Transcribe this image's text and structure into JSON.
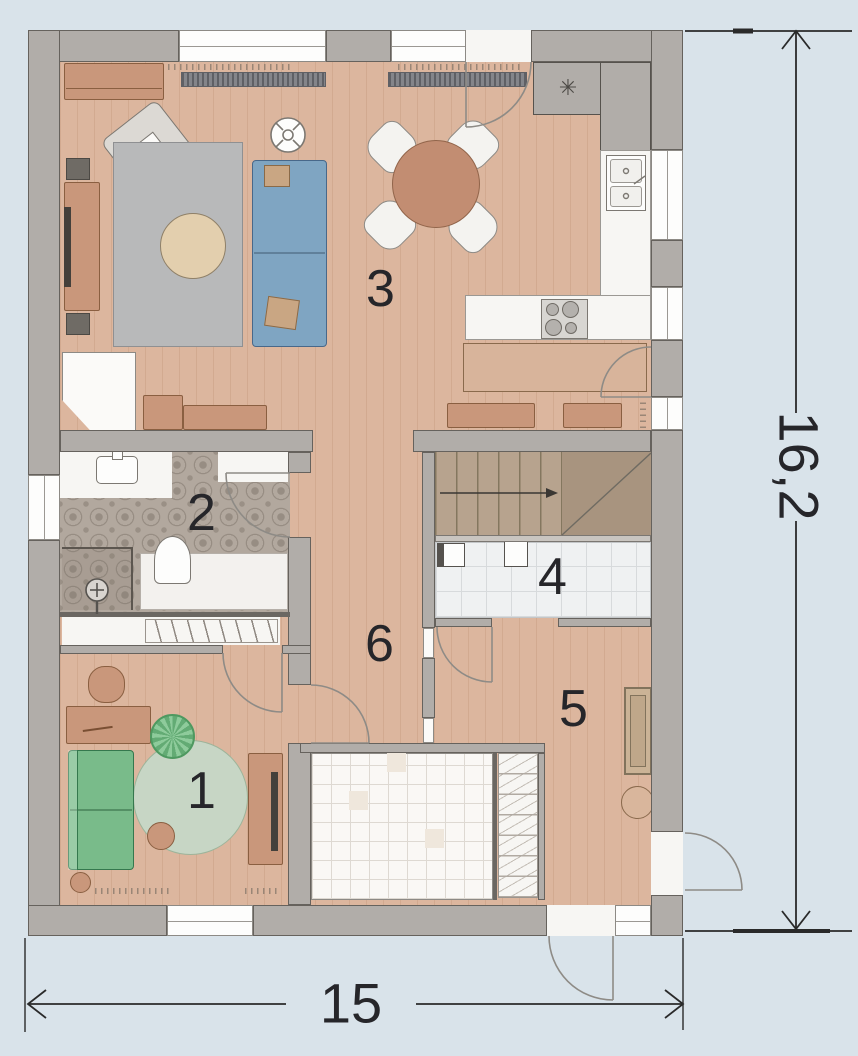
{
  "plan": {
    "rooms": {
      "r1": {
        "label": "1"
      },
      "r2": {
        "label": "2"
      },
      "r3": {
        "label": "3"
      },
      "r4": {
        "label": "4"
      },
      "r5": {
        "label": "5"
      },
      "r6": {
        "label": "6"
      }
    },
    "dimensions": {
      "width_label": "15",
      "height_label": "16,2"
    },
    "icons": {
      "freezer_icon": "✳"
    },
    "colors": {
      "background": "#d9e3ea",
      "wall": "#b1ada9",
      "wall_outline": "#66625d",
      "wood_floor": "#dcb69e",
      "bathroom_tile": "#b2a89e",
      "sofa_blue": "#7fa5c2",
      "sofa_green": "#79bb8a",
      "furniture_tan": "#c9977b",
      "dimension_line": "#2a2a2a",
      "label_text": "#26262a"
    }
  }
}
